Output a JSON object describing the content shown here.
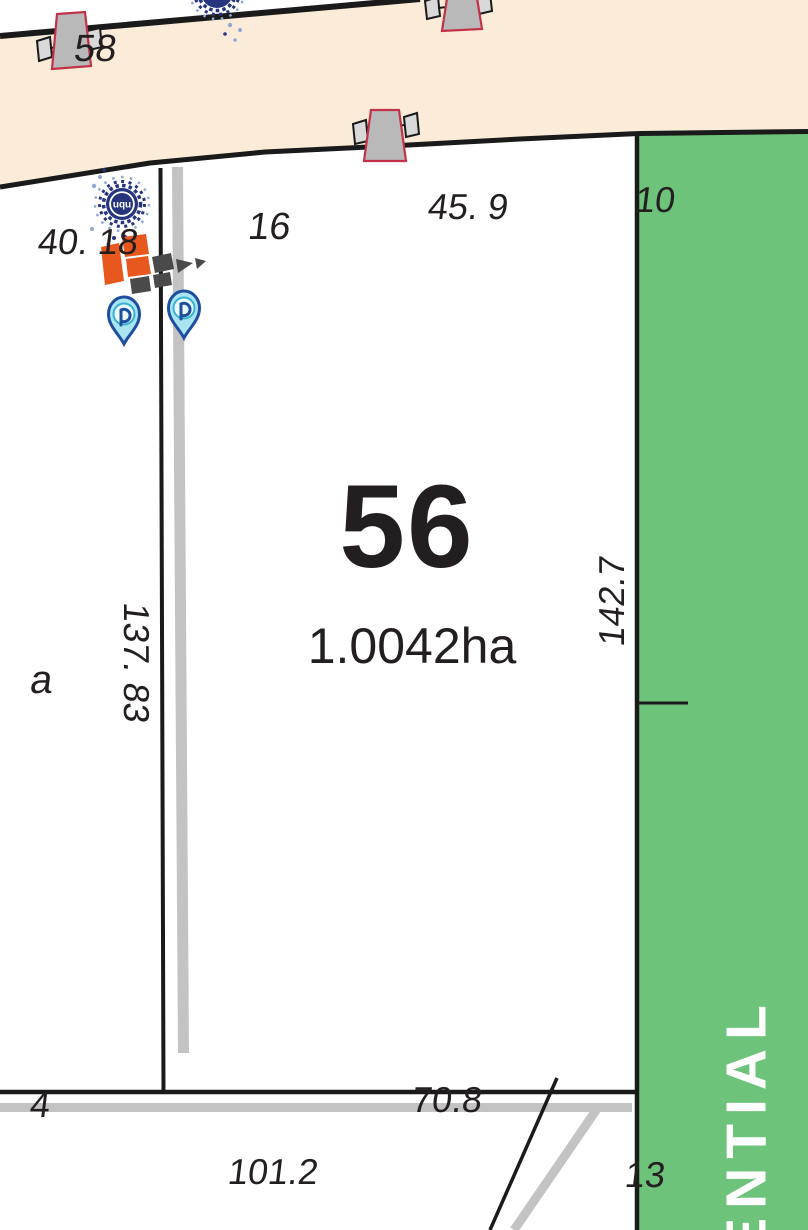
{
  "colors": {
    "road_fill": "#faecd9",
    "zone_green": "#6dc379",
    "boundary_black": "#1a1a1a",
    "road_gray": "#c3c3c3",
    "pole_gray": "#b9b9b9",
    "pole_outline_red": "#c23148",
    "marker_navy": "#27357e",
    "marker_halo_blue": "#8ea9d6",
    "pin_fill": "#a9e4f2",
    "pin_outline": "#1d4f9e",
    "logo_orange": "#e8571d",
    "logo_charcoal": "#4a4a4a",
    "text_dark": "#231f20",
    "zone_text": "#ffffff"
  },
  "lot": {
    "number": "56",
    "area": "1.0042ha"
  },
  "dimensions": {
    "west_boundary": "137. 83",
    "east_boundary": "142.7",
    "south_boundary": "70.8",
    "road_frontage": "45. 9",
    "road_left": "40. 18",
    "road_bottom": "101.2",
    "partial_bottom_left": "4",
    "partial_area_left": "a"
  },
  "neighbor_labels": {
    "top_left_lot": "58",
    "path_top": "16",
    "near_zone": "10",
    "bottom_right_lot": "13"
  },
  "zone": {
    "label_partial": "ENTIAL"
  },
  "markers": {
    "uqu_logo_text": "uqu"
  },
  "icons": {
    "utility_pole": "utility-pole-icon",
    "uqu_marker": "uqu-dotted-circle-icon",
    "tile_logo": "orange-tile-arrow-icon",
    "map_pin": "p-map-pin-icon"
  }
}
